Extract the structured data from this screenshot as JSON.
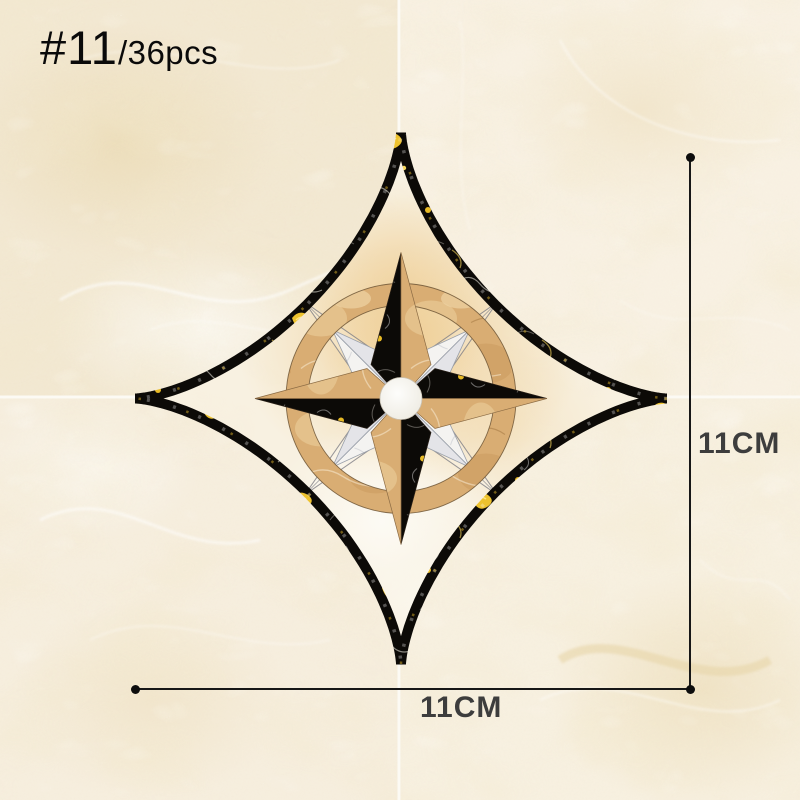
{
  "product": {
    "number_label": "#11",
    "pack_label": "/36pcs"
  },
  "dimensions": {
    "height_label": "11CM",
    "width_label": "11CM"
  },
  "palette": {
    "tile_cream": "#f6eedc",
    "grout_white": "#fcfaf4",
    "star_black": "#0c0a07",
    "ring_tan": "#d9ad73",
    "gold_vein": "#efc22f",
    "white_marble": "#f4f3f1",
    "glow_peach": "#eecb8e",
    "dimension_line": "#171717",
    "dimension_text": "#3d3d3d",
    "label_text": "#0a0a0a"
  }
}
